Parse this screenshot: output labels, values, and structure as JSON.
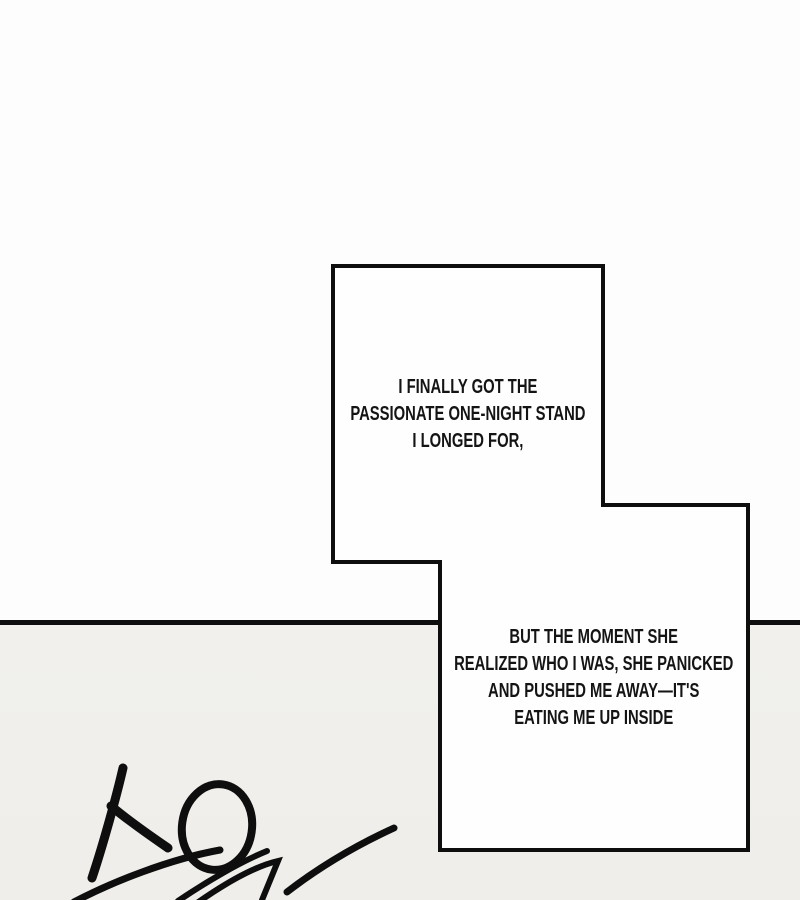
{
  "colors": {
    "page_background": "#fdfdfd",
    "lower_panel_background": "#f0efeb",
    "ink": "#0e0e0e",
    "box_fill": "#fefefe"
  },
  "speech_boxes": [
    {
      "lines": [
        "I FINALLY GOT THE",
        "PASSIONATE ONE-NIGHT STAND",
        "I LONGED FOR,"
      ]
    },
    {
      "lines": [
        "BUT THE MOMENT SHE",
        "REALIZED WHO I WAS, SHE PANICKED",
        "AND PUSHED ME AWAY—IT'S",
        "EATING ME UP INSIDE"
      ]
    }
  ],
  "sfx": {
    "text": "스윽"
  }
}
